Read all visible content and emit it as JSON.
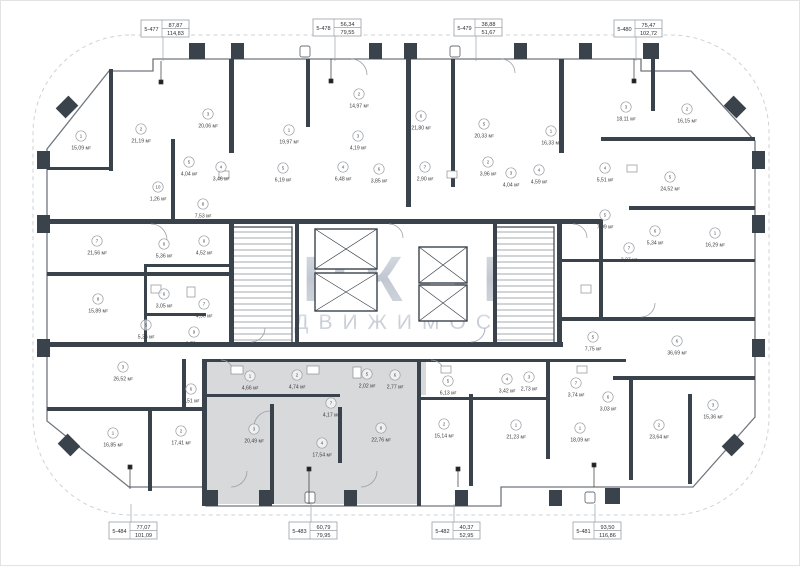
{
  "plan": {
    "watermark": {
      "line1": "ИНКОМ",
      "line2": "НЕДВИЖИМОСТЬ"
    },
    "area_unit": "м²",
    "highlighted_apartment": "5-483",
    "colors": {
      "wall": "#3a434c",
      "highlight": "#d8d9db",
      "watermark": "#c2c9d3"
    },
    "apartments": [
      {
        "id": "5-477",
        "area_top": "87,87",
        "area_bottom": "114,83",
        "side": "top",
        "x": 140,
        "y": 19,
        "line_x": 162
      },
      {
        "id": "5-478",
        "area_top": "56,34",
        "area_bottom": "79,55",
        "side": "top",
        "x": 312,
        "y": 18,
        "line_x": 334
      },
      {
        "id": "5-479",
        "area_top": "38,88",
        "area_bottom": "51,67",
        "side": "top",
        "x": 453,
        "y": 18,
        "line_x": 475
      },
      {
        "id": "5-480",
        "area_top": "75,47",
        "area_bottom": "102,72",
        "side": "top",
        "x": 613,
        "y": 19,
        "line_x": 635
      },
      {
        "id": "5-484",
        "area_top": "77,07",
        "area_bottom": "101,09",
        "side": "bottom",
        "x": 108,
        "y": 521,
        "line_x": 130
      },
      {
        "id": "5-483",
        "area_top": "60,79",
        "area_bottom": "79,95",
        "side": "bottom",
        "x": 288,
        "y": 521,
        "line_x": 310
      },
      {
        "id": "5-482",
        "area_top": "40,37",
        "area_bottom": "52,95",
        "side": "bottom",
        "x": 431,
        "y": 521,
        "line_x": 453
      },
      {
        "id": "5-481",
        "area_top": "93,50",
        "area_bottom": "116,86",
        "side": "bottom",
        "x": 572,
        "y": 521,
        "line_x": 594
      }
    ],
    "rooms": [
      {
        "n": "1",
        "area": "15,09",
        "x": 80,
        "y": 135
      },
      {
        "n": "2",
        "area": "21,19",
        "x": 140,
        "y": 128
      },
      {
        "n": "3",
        "area": "20,06",
        "x": 207,
        "y": 113
      },
      {
        "n": "5",
        "area": "4,04",
        "x": 188,
        "y": 161
      },
      {
        "n": "4",
        "area": "3,46",
        "x": 220,
        "y": 166
      },
      {
        "n": "10",
        "area": "1,26",
        "x": 157,
        "y": 186
      },
      {
        "n": "8",
        "area": "7,53",
        "x": 202,
        "y": 203
      },
      {
        "n": "7",
        "area": "21,56",
        "x": 96,
        "y": 240
      },
      {
        "n": "6",
        "area": "5,36",
        "x": 163,
        "y": 243
      },
      {
        "n": "9",
        "area": "4,52",
        "x": 203,
        "y": 240
      },
      {
        "n": "8",
        "area": "15,89",
        "x": 97,
        "y": 298
      },
      {
        "n": "6",
        "area": "3,05",
        "x": 163,
        "y": 293
      },
      {
        "n": "5",
        "area": "5,36",
        "x": 145,
        "y": 324
      },
      {
        "n": "7",
        "area": "4,96",
        "x": 203,
        "y": 303
      },
      {
        "n": "9",
        "area": "6,73",
        "x": 193,
        "y": 331
      },
      {
        "n": "3",
        "area": "26,52",
        "x": 122,
        "y": 366
      },
      {
        "n": "6",
        "area": "3,51",
        "x": 190,
        "y": 388
      },
      {
        "n": "1",
        "area": "16,85",
        "x": 112,
        "y": 432
      },
      {
        "n": "2",
        "area": "17,41",
        "x": 180,
        "y": 430
      },
      {
        "n": "1",
        "area": "4,66",
        "x": 249,
        "y": 375
      },
      {
        "n": "2",
        "area": "4,74",
        "x": 296,
        "y": 374
      },
      {
        "n": "5",
        "area": "2,02",
        "x": 366,
        "y": 373
      },
      {
        "n": "6",
        "area": "2,77",
        "x": 394,
        "y": 374
      },
      {
        "n": "7",
        "area": "4,17",
        "x": 330,
        "y": 402
      },
      {
        "n": "3",
        "area": "20,49",
        "x": 253,
        "y": 428
      },
      {
        "n": "4",
        "area": "17,54",
        "x": 321,
        "y": 442
      },
      {
        "n": "8",
        "area": "22,76",
        "x": 380,
        "y": 427
      },
      {
        "n": "5",
        "area": "6,13",
        "x": 447,
        "y": 380
      },
      {
        "n": "4",
        "area": "3,42",
        "x": 506,
        "y": 378
      },
      {
        "n": "3",
        "area": "2,73",
        "x": 528,
        "y": 376
      },
      {
        "n": "7",
        "area": "3,74",
        "x": 575,
        "y": 382
      },
      {
        "n": "2",
        "area": "15,14",
        "x": 443,
        "y": 423
      },
      {
        "n": "1",
        "area": "21,23",
        "x": 515,
        "y": 424
      },
      {
        "n": "1",
        "area": "18,09",
        "x": 579,
        "y": 427
      },
      {
        "n": "5",
        "area": "7,75",
        "x": 592,
        "y": 336
      },
      {
        "n": "6",
        "area": "36,69",
        "x": 676,
        "y": 340
      },
      {
        "n": "6",
        "area": "3,03",
        "x": 607,
        "y": 396
      },
      {
        "n": "2",
        "area": "23,64",
        "x": 658,
        "y": 424
      },
      {
        "n": "3",
        "area": "15,36",
        "x": 712,
        "y": 404
      },
      {
        "n": "1",
        "area": "19,97",
        "x": 288,
        "y": 129
      },
      {
        "n": "2",
        "area": "14,97",
        "x": 358,
        "y": 93
      },
      {
        "n": "3",
        "area": "4,19",
        "x": 357,
        "y": 135
      },
      {
        "n": "5",
        "area": "6,19",
        "x": 282,
        "y": 167
      },
      {
        "n": "4",
        "area": "6,48",
        "x": 342,
        "y": 166
      },
      {
        "n": "6",
        "area": "3,85",
        "x": 378,
        "y": 168
      },
      {
        "n": "6",
        "area": "21,80",
        "x": 420,
        "y": 115
      },
      {
        "n": "7",
        "area": "2,90",
        "x": 424,
        "y": 166
      },
      {
        "n": "5",
        "area": "20,33",
        "x": 483,
        "y": 123
      },
      {
        "n": "1",
        "area": "16,33",
        "x": 550,
        "y": 130
      },
      {
        "n": "2",
        "area": "3,96",
        "x": 487,
        "y": 161
      },
      {
        "n": "3",
        "area": "4,04",
        "x": 510,
        "y": 172
      },
      {
        "n": "4",
        "area": "4,59",
        "x": 538,
        "y": 169
      },
      {
        "n": "3",
        "area": "18,11",
        "x": 625,
        "y": 106
      },
      {
        "n": "2",
        "area": "16,15",
        "x": 686,
        "y": 108
      },
      {
        "n": "4",
        "area": "5,51",
        "x": 604,
        "y": 167
      },
      {
        "n": "5",
        "area": "24,52",
        "x": 669,
        "y": 176
      },
      {
        "n": "5",
        "area": "7,09",
        "x": 604,
        "y": 214
      },
      {
        "n": "6",
        "area": "5,34",
        "x": 654,
        "y": 230
      },
      {
        "n": "1",
        "area": "16,29",
        "x": 714,
        "y": 232
      },
      {
        "n": "7",
        "area": "3,27",
        "x": 628,
        "y": 247
      }
    ]
  }
}
